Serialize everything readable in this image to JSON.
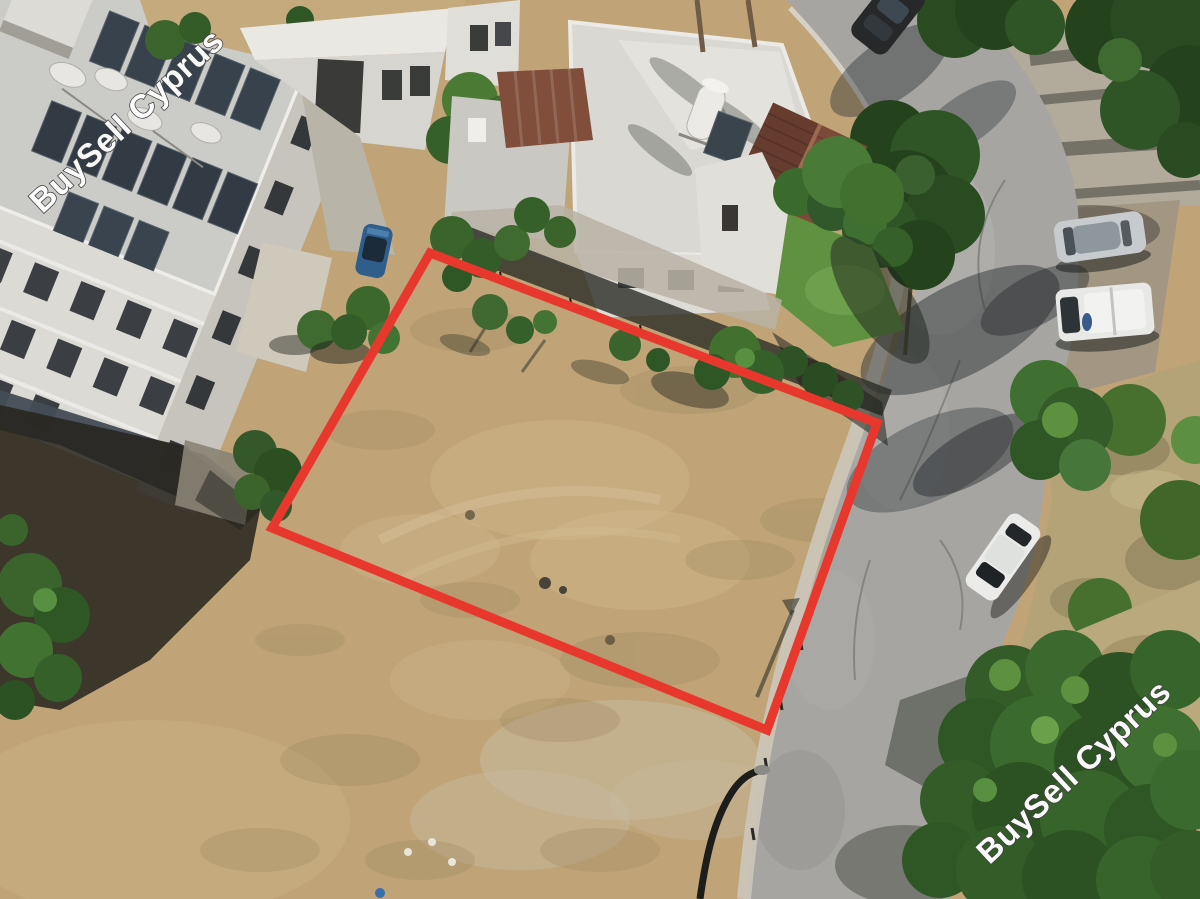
{
  "meta": {
    "type": "aerial-drone-photo",
    "subject": "residential building plot for sale outlined in red",
    "width_px": 1200,
    "height_px": 899
  },
  "watermark": {
    "text": "BuySell Cyprus",
    "fill": "#ffffff",
    "outline": "#3f3f3f"
  },
  "plot_outline": {
    "shape": "quadrilateral",
    "color": "#e8382e",
    "stroke_width": "9",
    "points": "430,253 877,423 767,730 272,528"
  },
  "scene": {
    "palette": {
      "dry_field": "#c0a478",
      "asphalt_road": "#a6a5a1",
      "vegetation": "#3a642c",
      "buildings": "#dcdad4",
      "tiled_roof": "#7d4a39"
    },
    "elements": [
      {
        "name": "apartment-building",
        "label": "white apartment block with rooftop solar panels"
      },
      {
        "name": "neighbor-buildings",
        "label": "white houses with flat roofs"
      },
      {
        "name": "tiled-roof-house",
        "label": "house with brown tiled roof"
      },
      {
        "name": "corner-garden",
        "label": "green lawn at street corner"
      },
      {
        "name": "road",
        "label": "asphalt road curving along the plot"
      },
      {
        "name": "plot-field",
        "label": "dry grass building plot"
      },
      {
        "name": "parked-car-dark",
        "label": "dark car on upper road"
      },
      {
        "name": "parked-car-silver",
        "label": "silver sedan parked off road"
      },
      {
        "name": "parked-pickup-white",
        "label": "white pickup parked off road"
      },
      {
        "name": "car-white",
        "label": "white sedan parked at road edge"
      },
      {
        "name": "car-blue",
        "label": "blue car in alley"
      },
      {
        "name": "streetlight",
        "label": "street lamp near bottom of road"
      },
      {
        "name": "trees",
        "label": "green trees and dry brush"
      }
    ]
  }
}
